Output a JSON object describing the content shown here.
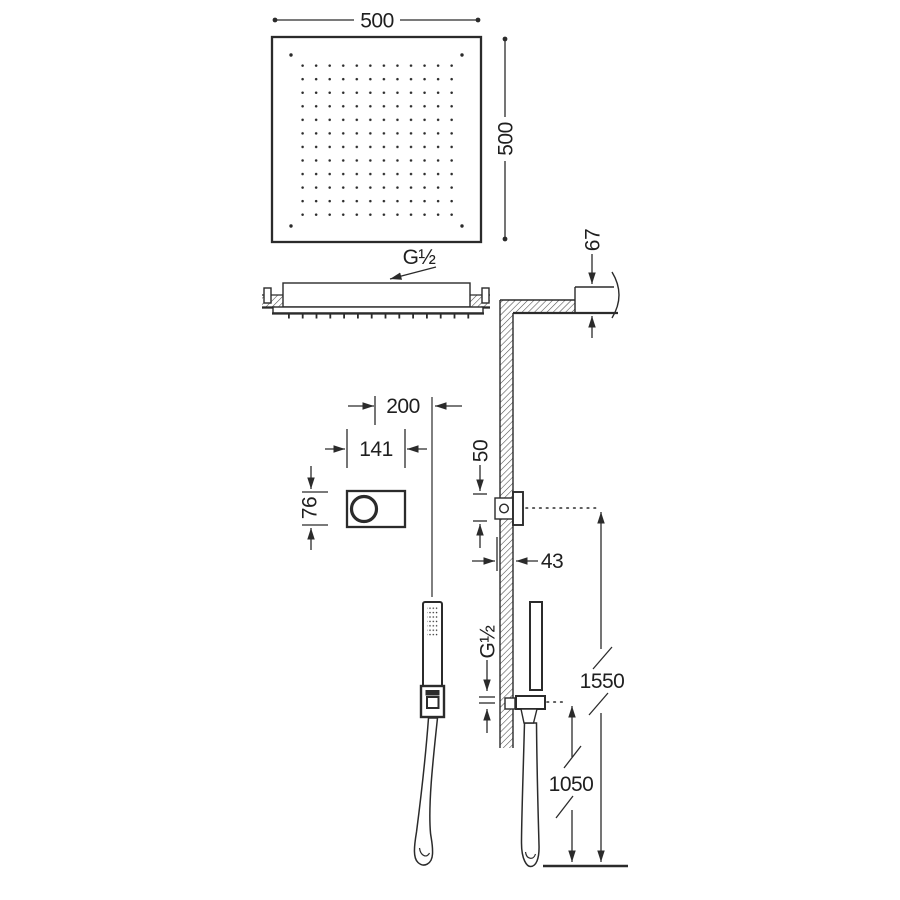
{
  "diagram": {
    "title": "shower-system-installation-drawing",
    "dims": {
      "head_width": "500",
      "head_height": "500",
      "head_thread": "G½",
      "ceiling_clearance": "67",
      "control_offset": "200",
      "control_width": "141",
      "control_height": "76",
      "outlet_size": "50",
      "outlet_depth": "43",
      "hand_thread": "G½",
      "outlet_floor_height": "1550",
      "handset_floor_height": "1050"
    },
    "line_color": "#2b2b2b",
    "background": "#ffffff"
  }
}
